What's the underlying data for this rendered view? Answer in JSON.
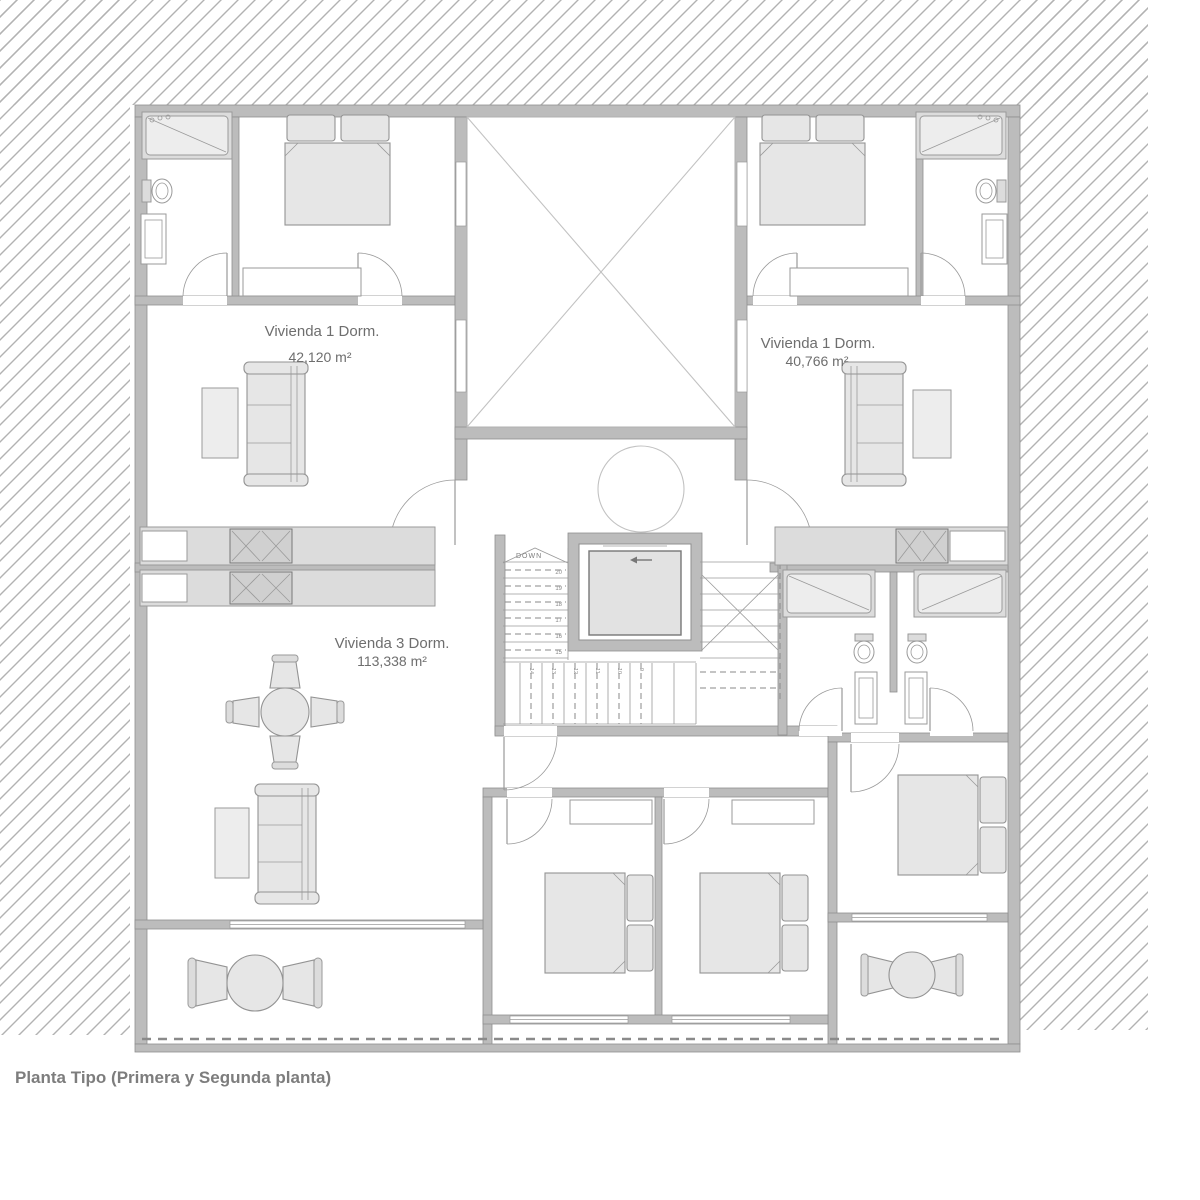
{
  "caption": "Planta Tipo (Primera y Segunda planta)",
  "units": [
    {
      "name": "Vivienda  1 Dorm.",
      "area": "42,120 m²"
    },
    {
      "name": "Vivienda 1 Dorm.",
      "area": "40,766 m²"
    },
    {
      "name": "Vivienda 3 Dorm.",
      "area": "113,338 m²"
    }
  ],
  "stairs": {
    "down_label": "DOWN",
    "left_flight_steps": [
      "20",
      "19",
      "18",
      "17",
      "16",
      "15"
    ],
    "bottom_flight_steps": [
      "14",
      "13",
      "12",
      "11",
      "10",
      "9"
    ]
  },
  "colors": {
    "background": "#ffffff",
    "hatch_line": "#b2b2b2",
    "wall_fill": "#bcbcbc",
    "wall_stroke": "#8f8f8f",
    "line": "#9a9a9a",
    "furniture_fill": "#e6e6e6",
    "label_text": "#6e6e6e",
    "caption_text": "#7d7d7d"
  }
}
